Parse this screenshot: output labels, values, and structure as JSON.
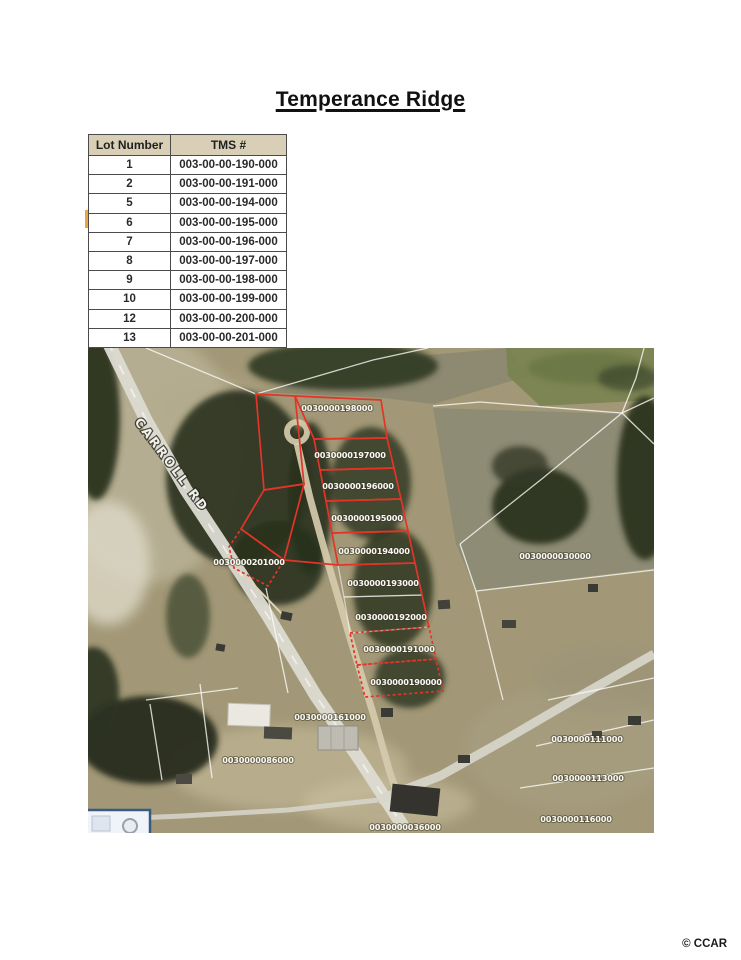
{
  "page": {
    "title": "Temperance Ridge",
    "credit": "© CCAR"
  },
  "lot_table": {
    "headers": [
      "Lot Number",
      "TMS #"
    ],
    "rows": [
      {
        "lot": "1",
        "tms": "003-00-00-190-000"
      },
      {
        "lot": "2",
        "tms": "003-00-00-191-000"
      },
      {
        "lot": "5",
        "tms": "003-00-00-194-000"
      },
      {
        "lot": "6",
        "tms": "003-00-00-195-000"
      },
      {
        "lot": "7",
        "tms": "003-00-00-196-000"
      },
      {
        "lot": "8",
        "tms": "003-00-00-197-000"
      },
      {
        "lot": "9",
        "tms": "003-00-00-198-000"
      },
      {
        "lot": "10",
        "tms": "003-00-00-199-000"
      },
      {
        "lot": "12",
        "tms": "003-00-00-200-000"
      },
      {
        "lot": "13",
        "tms": "003-00-00-201-000"
      }
    ]
  },
  "map": {
    "road_label": "CARROLL RD",
    "colors": {
      "parcel_outline": "#e33428"
    },
    "labels": {
      "l198": "0030000198000",
      "l197": "0030000197000",
      "l196": "0030000196000",
      "l195": "0030000195000",
      "l194": "0030000194000",
      "l193": "0030000193000",
      "l192": "0030000192000",
      "l191": "0030000191000",
      "l190": "0030000190000",
      "l201": "0030000201000",
      "l030": "0030000030000",
      "l161": "0030000161000",
      "l111": "0030000111000",
      "l113": "0030000113000",
      "l116": "0030000116000",
      "l036": "0030000036000",
      "l086": "0030000086000"
    }
  }
}
